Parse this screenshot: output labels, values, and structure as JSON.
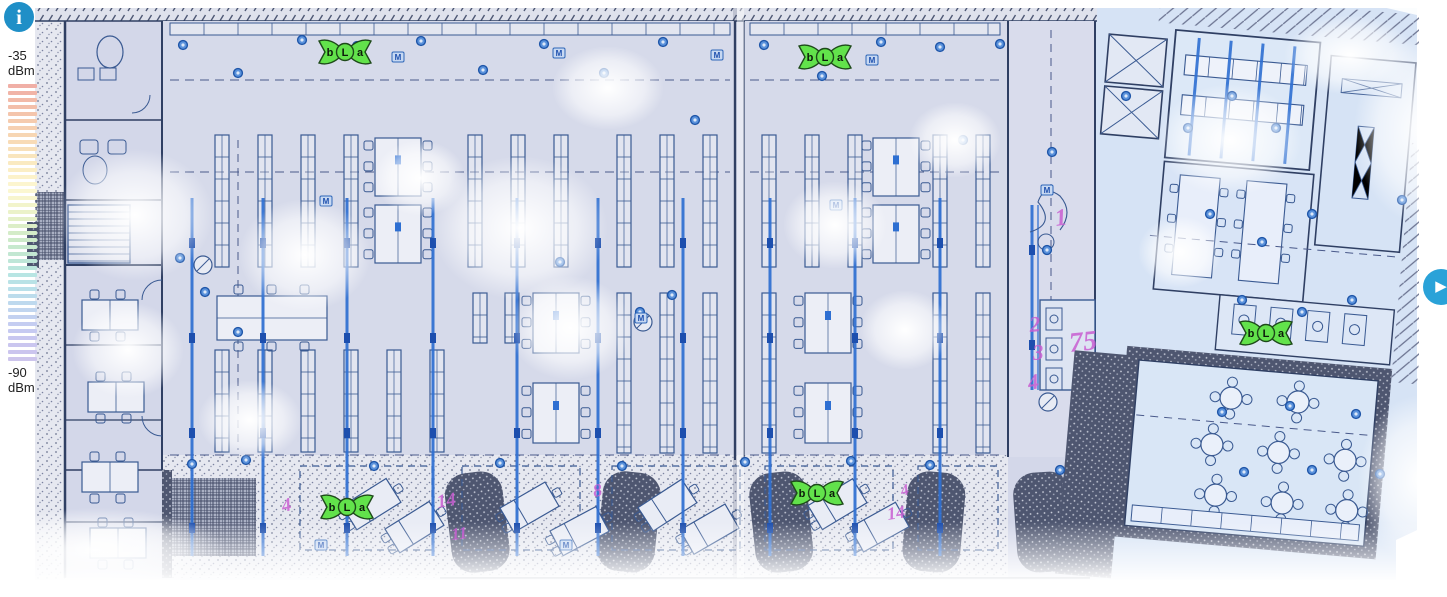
{
  "legend": {
    "max_value": "-35",
    "max_unit": "dBm",
    "min_value": "-90",
    "min_unit": "dBm",
    "stripe_colors": [
      "#f0afa6",
      "#f2bca9",
      "#f5caae",
      "#f7d8b4",
      "#f9e4bc",
      "#fbefc6",
      "#fdf7d2",
      "#f2f4cb",
      "#e0efc6",
      "#cdeac9",
      "#c0e7d4",
      "#b8e5e2",
      "#badfeb",
      "#c0d6ef",
      "#c5ccf1",
      "#c9c6f0",
      "#cdc5ec"
    ]
  },
  "controls": {
    "info_button_glyph": "i",
    "expand_button_glyph": "▶"
  },
  "access_points": [
    {
      "id": "ap-1",
      "bands": [
        "b",
        "L",
        "a"
      ],
      "x": 345,
      "y": 52
    },
    {
      "id": "ap-2",
      "bands": [
        "b",
        "L",
        "a"
      ],
      "x": 825,
      "y": 57
    },
    {
      "id": "ap-3",
      "bands": [
        "b",
        "L",
        "a"
      ],
      "x": 347,
      "y": 507
    },
    {
      "id": "ap-4",
      "bands": [
        "b",
        "L",
        "a"
      ],
      "x": 817,
      "y": 493
    },
    {
      "id": "ap-5",
      "bands": [
        "b",
        "L",
        "a"
      ],
      "x": 1266,
      "y": 333
    }
  ],
  "annotations": [
    {
      "text": "1",
      "x": 1056,
      "y": 226,
      "size": 24,
      "rot": -8
    },
    {
      "text": "2",
      "x": 1030,
      "y": 332,
      "size": 22,
      "rot": -5
    },
    {
      "text": "3",
      "x": 1033,
      "y": 360,
      "size": 22,
      "rot": -4
    },
    {
      "text": "4",
      "x": 1029,
      "y": 390,
      "size": 22,
      "rot": -10
    },
    {
      "text": "75",
      "x": 1070,
      "y": 352,
      "size": 28,
      "rot": -6
    },
    {
      "text": "4",
      "x": 283,
      "y": 512,
      "size": 19,
      "rot": -12
    },
    {
      "text": "14",
      "x": 438,
      "y": 508,
      "size": 19,
      "rot": -10
    },
    {
      "text": "11",
      "x": 452,
      "y": 540,
      "size": 17,
      "rot": -8
    },
    {
      "text": "8",
      "x": 594,
      "y": 497,
      "size": 18,
      "rot": -10
    },
    {
      "text": "14",
      "x": 888,
      "y": 520,
      "size": 18,
      "rot": -9
    },
    {
      "text": "4",
      "x": 902,
      "y": 496,
      "size": 16,
      "rot": -14
    }
  ],
  "colors": {
    "plan_background": "#d3d7e9",
    "wing_background": "#d6e3f5",
    "blueprint_line": "#3a5a92",
    "accent_blue": "#2e6fd2",
    "survey_dot": "#5a92dc",
    "survey_dot_ring": "#1e55a8",
    "exterior_dark": "#4e5670",
    "stipple_light_bg": "#e6e8f0",
    "marker_fill": "#62e24b",
    "marker_outline": "#1e4a1a",
    "annotation_pink": "#c95fd2",
    "info_button": "#1f8fc7",
    "expand_button": "#2aa2d8",
    "legend_text": "#222222"
  }
}
